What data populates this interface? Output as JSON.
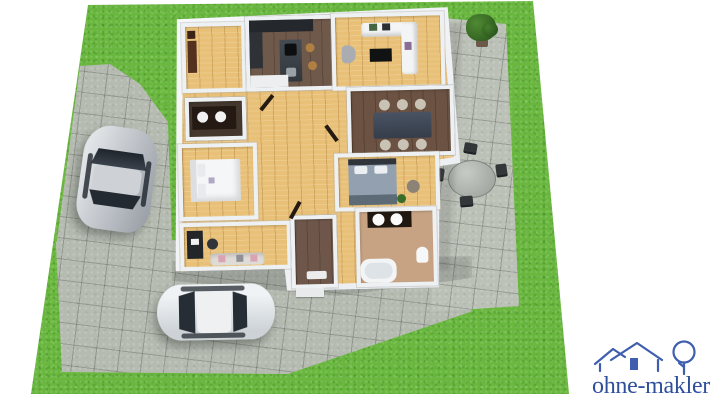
{
  "branding": {
    "logo_text": "ohne-makler",
    "logo_color": "#2e4f9c",
    "logo_icon": "house-and-tree-line-art"
  },
  "scene": {
    "type": "isometric-3d-floor-plan",
    "palette": {
      "background": "#ffffff",
      "lawn_green": "#69b73e",
      "paving_gray": "#b6bbb2",
      "patio_gray": "#bcc1b8",
      "wall_white": "#f3f5f7",
      "light_wood_floor": "#e8c078",
      "dark_wood_floor": "#6f594b",
      "bathroom_floor": "#c7a384",
      "logo_blue": "#2e4f9c"
    },
    "garden": {
      "lawn": "green grass parcel",
      "driveway_material": "gray stone pavers",
      "patio_material": "gray stone pavers",
      "potted_plant_count": 1,
      "patio_set": {
        "table_shape": "round",
        "chairs": 4
      }
    },
    "vehicles": [
      {
        "name": "silver-sedan",
        "location": "driveway-left",
        "body_color": "#c9cdd2"
      },
      {
        "name": "white-sedan",
        "location": "driveway-front",
        "body_color": "#e6e9eb"
      }
    ],
    "rooms": [
      {
        "name": "entry",
        "floor": "light-wood",
        "furniture": [
          "sideboard"
        ]
      },
      {
        "name": "kitchen",
        "floor": "dark-wood",
        "furniture": [
          "wall-cabinets",
          "tall-cabinet",
          "island-with-hob-and-sink",
          "2-bar-stools",
          "white-counter"
        ]
      },
      {
        "name": "living-room",
        "floor": "light-wood",
        "furniture": [
          "corner-sofa",
          "coffee-table",
          "armchair"
        ]
      },
      {
        "name": "dining-room",
        "floor": "dark-wood",
        "furniture": [
          "dining-table",
          "6-chairs"
        ]
      },
      {
        "name": "utility-room",
        "floor": "dark-wood",
        "furniture": [
          "counter",
          "washing-machine",
          "laundry-sink"
        ]
      },
      {
        "name": "bedroom",
        "floor": "light-wood",
        "furniture": [
          "double-bed"
        ]
      },
      {
        "name": "master-bedroom",
        "floor": "light-wood",
        "furniture": [
          "double-bed",
          "pouf",
          "plant"
        ]
      },
      {
        "name": "office",
        "floor": "light-wood",
        "furniture": [
          "desk-with-monitor",
          "office-chair",
          "sofa"
        ]
      },
      {
        "name": "entrance-hall",
        "floor": "dark-wood",
        "furniture": [
          "doormat"
        ]
      },
      {
        "name": "bathroom",
        "floor": "beige-tile",
        "furniture": [
          "double-vanity",
          "bathtub",
          "toilet"
        ]
      },
      {
        "name": "hallway",
        "floor": "light-wood",
        "furniture": []
      }
    ]
  }
}
